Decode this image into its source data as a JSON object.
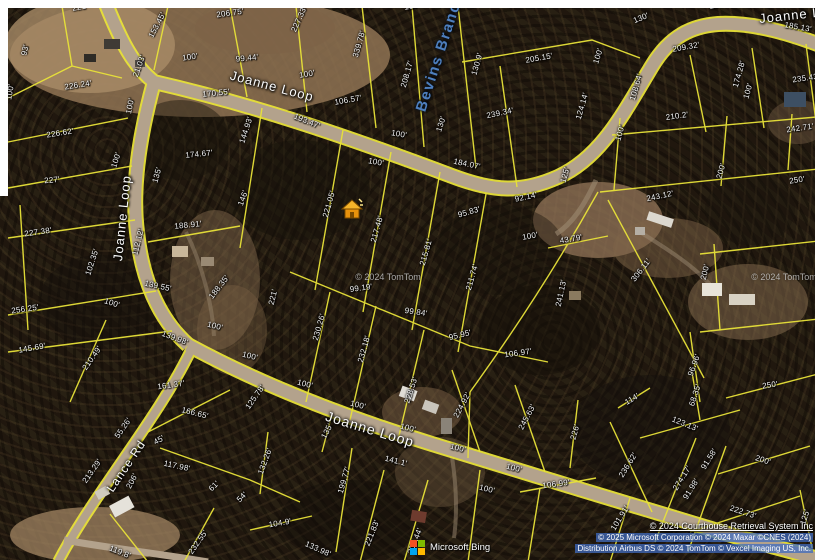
{
  "colors": {
    "parcel_line": "#e8e239",
    "road_fill": "#b3a28c",
    "water_label": "#4e7fbe",
    "marker_body": "#e8920c",
    "marker_roof": "#f5b32a"
  },
  "map": {
    "road_labels": [
      {
        "t": "Joanne Loop",
        "x": 272,
        "y": 86,
        "r": 15,
        "s": 13
      },
      {
        "t": "Joanne Loop",
        "x": 802,
        "y": 14,
        "r": -6,
        "s": 13
      },
      {
        "t": "Joanne Loop",
        "x": 122,
        "y": 218,
        "r": -84,
        "s": 13
      },
      {
        "t": "Joanne Loop",
        "x": 370,
        "y": 429,
        "r": 17,
        "s": 14
      },
      {
        "t": "Lance Rd",
        "x": 126,
        "y": 466,
        "r": -56,
        "s": 12
      }
    ],
    "water_labels": [
      {
        "t": "Bevins Branch",
        "x": 440,
        "y": 52,
        "r": -72,
        "s": 15
      }
    ],
    "dimension_labels": [
      {
        "t": "221'",
        "x": 80,
        "y": 7,
        "r": -10
      },
      {
        "t": "93'",
        "x": 25,
        "y": 50,
        "r": -78
      },
      {
        "t": "226.24'",
        "x": 78,
        "y": 85,
        "r": -9
      },
      {
        "t": "100'",
        "x": 10,
        "y": 92,
        "r": -80
      },
      {
        "t": "226.62'",
        "x": 60,
        "y": 133,
        "r": -9
      },
      {
        "t": "227'",
        "x": 52,
        "y": 180,
        "r": -6
      },
      {
        "t": "227.38'",
        "x": 38,
        "y": 232,
        "r": -8
      },
      {
        "t": "256.25'",
        "x": 25,
        "y": 309,
        "r": -8
      },
      {
        "t": "145.69'",
        "x": 32,
        "y": 348,
        "r": -10
      },
      {
        "t": "153.45'",
        "x": 157,
        "y": 25,
        "r": -62
      },
      {
        "t": "206.75'",
        "x": 230,
        "y": 13,
        "r": -8
      },
      {
        "t": "21.03'",
        "x": 139,
        "y": 66,
        "r": -70
      },
      {
        "t": "100'",
        "x": 130,
        "y": 106,
        "r": -78
      },
      {
        "t": "100'",
        "x": 116,
        "y": 160,
        "r": -72
      },
      {
        "t": "100'",
        "x": 190,
        "y": 57,
        "r": -8
      },
      {
        "t": "99.44'",
        "x": 247,
        "y": 58,
        "r": -6
      },
      {
        "t": "170.55'",
        "x": 216,
        "y": 93,
        "r": -6
      },
      {
        "t": "144.93'",
        "x": 246,
        "y": 130,
        "r": -72
      },
      {
        "t": "174.67'",
        "x": 199,
        "y": 154,
        "r": -6
      },
      {
        "t": "135'",
        "x": 157,
        "y": 175,
        "r": -74
      },
      {
        "t": "227.33'",
        "x": 299,
        "y": 19,
        "r": -66
      },
      {
        "t": "339.78'",
        "x": 359,
        "y": 44,
        "r": -74
      },
      {
        "t": "208.17'",
        "x": 407,
        "y": 74,
        "r": -74
      },
      {
        "t": "130.9'",
        "x": 477,
        "y": 64,
        "r": -74
      },
      {
        "t": "100'",
        "x": 307,
        "y": 74,
        "r": -10
      },
      {
        "t": "106.57'",
        "x": 348,
        "y": 100,
        "r": -10
      },
      {
        "t": "193.47'",
        "x": 307,
        "y": 121,
        "r": 22
      },
      {
        "t": "100'",
        "x": 399,
        "y": 134,
        "r": 10
      },
      {
        "t": "130'",
        "x": 441,
        "y": 124,
        "r": -72
      },
      {
        "t": "184.07'",
        "x": 467,
        "y": 164,
        "r": 12
      },
      {
        "t": "100'",
        "x": 376,
        "y": 162,
        "r": 10
      },
      {
        "t": "239.34'",
        "x": 500,
        "y": 113,
        "r": -12
      },
      {
        "t": "205.15'",
        "x": 539,
        "y": 58,
        "r": -10
      },
      {
        "t": "100'",
        "x": 412,
        "y": 6,
        "r": -10
      },
      {
        "t": "125'",
        "x": 717,
        "y": 5,
        "r": -10
      },
      {
        "t": "130'",
        "x": 641,
        "y": 18,
        "r": -22
      },
      {
        "t": "185.13'",
        "x": 798,
        "y": 27,
        "r": 10
      },
      {
        "t": "209.32'",
        "x": 686,
        "y": 47,
        "r": -10
      },
      {
        "t": "100'",
        "x": 598,
        "y": 56,
        "r": -72
      },
      {
        "t": "108.64'",
        "x": 636,
        "y": 87,
        "r": -74
      },
      {
        "t": "174.28'",
        "x": 739,
        "y": 74,
        "r": -74
      },
      {
        "t": "100'",
        "x": 748,
        "y": 91,
        "r": -74
      },
      {
        "t": "235.43'",
        "x": 806,
        "y": 78,
        "r": -8
      },
      {
        "t": "124.14'",
        "x": 582,
        "y": 106,
        "r": -74
      },
      {
        "t": "210.2'",
        "x": 677,
        "y": 116,
        "r": -8
      },
      {
        "t": "242.71'",
        "x": 800,
        "y": 128,
        "r": -8
      },
      {
        "t": "100'",
        "x": 620,
        "y": 133,
        "r": -74
      },
      {
        "t": "125'",
        "x": 565,
        "y": 175,
        "r": -74
      },
      {
        "t": "200'",
        "x": 721,
        "y": 171,
        "r": -74
      },
      {
        "t": "250'",
        "x": 797,
        "y": 180,
        "r": -8
      },
      {
        "t": "92.14'",
        "x": 526,
        "y": 197,
        "r": -12
      },
      {
        "t": "95.83'",
        "x": 469,
        "y": 212,
        "r": -16
      },
      {
        "t": "100'",
        "x": 530,
        "y": 236,
        "r": -10
      },
      {
        "t": "243.12'",
        "x": 660,
        "y": 196,
        "r": -12
      },
      {
        "t": "43.79'",
        "x": 571,
        "y": 239,
        "r": -10
      },
      {
        "t": "306.11'",
        "x": 641,
        "y": 270,
        "r": -52
      },
      {
        "t": "241.13'",
        "x": 561,
        "y": 293,
        "r": -78
      },
      {
        "t": "200'",
        "x": 705,
        "y": 272,
        "r": -76
      },
      {
        "t": "96.96'",
        "x": 694,
        "y": 365,
        "r": -70
      },
      {
        "t": "221.05'",
        "x": 329,
        "y": 204,
        "r": -74
      },
      {
        "t": "217.48'",
        "x": 377,
        "y": 229,
        "r": -74
      },
      {
        "t": "215.81'",
        "x": 426,
        "y": 252,
        "r": -74
      },
      {
        "t": "211.74'",
        "x": 472,
        "y": 277,
        "r": -74
      },
      {
        "t": "188.91'",
        "x": 188,
        "y": 225,
        "r": -6
      },
      {
        "t": "146'",
        "x": 243,
        "y": 198,
        "r": -70
      },
      {
        "t": "112.12'",
        "x": 138,
        "y": 242,
        "r": -76
      },
      {
        "t": "102.35'",
        "x": 92,
        "y": 262,
        "r": -72
      },
      {
        "t": "139.55'",
        "x": 158,
        "y": 286,
        "r": 12
      },
      {
        "t": "100'",
        "x": 112,
        "y": 303,
        "r": 18
      },
      {
        "t": "221'",
        "x": 273,
        "y": 297,
        "r": -76
      },
      {
        "t": "188.35'",
        "x": 219,
        "y": 287,
        "r": -52
      },
      {
        "t": "139.98'",
        "x": 175,
        "y": 338,
        "r": 20
      },
      {
        "t": "210.49'",
        "x": 92,
        "y": 358,
        "r": -55
      },
      {
        "t": "100'",
        "x": 215,
        "y": 326,
        "r": 14
      },
      {
        "t": "100'",
        "x": 250,
        "y": 356,
        "r": 14
      },
      {
        "t": "99.19'",
        "x": 361,
        "y": 288,
        "r": -8
      },
      {
        "t": "99.84'",
        "x": 416,
        "y": 312,
        "r": 8
      },
      {
        "t": "230.26'",
        "x": 319,
        "y": 327,
        "r": -74
      },
      {
        "t": "232.18'",
        "x": 364,
        "y": 349,
        "r": -74
      },
      {
        "t": "95.95'",
        "x": 460,
        "y": 335,
        "r": -14
      },
      {
        "t": "106.97'",
        "x": 518,
        "y": 353,
        "r": -8
      },
      {
        "t": "228.53'",
        "x": 411,
        "y": 390,
        "r": -72
      },
      {
        "t": "161.37'",
        "x": 171,
        "y": 385,
        "r": -8
      },
      {
        "t": "166.65'",
        "x": 195,
        "y": 413,
        "r": 14
      },
      {
        "t": "125.78'",
        "x": 255,
        "y": 397,
        "r": -55
      },
      {
        "t": "55.26'",
        "x": 123,
        "y": 428,
        "r": -55
      },
      {
        "t": "45'",
        "x": 159,
        "y": 440,
        "r": -30
      },
      {
        "t": "117.98'",
        "x": 177,
        "y": 466,
        "r": 12
      },
      {
        "t": "206'",
        "x": 132,
        "y": 481,
        "r": -62
      },
      {
        "t": "213.29'",
        "x": 92,
        "y": 471,
        "r": -55
      },
      {
        "t": "61'",
        "x": 214,
        "y": 486,
        "r": -45
      },
      {
        "t": "54'",
        "x": 242,
        "y": 497,
        "r": -45
      },
      {
        "t": "132.26'",
        "x": 265,
        "y": 461,
        "r": -70
      },
      {
        "t": "119.8'",
        "x": 120,
        "y": 552,
        "r": 22
      },
      {
        "t": "232.55'",
        "x": 198,
        "y": 542,
        "r": -55
      },
      {
        "t": "104.9'",
        "x": 280,
        "y": 523,
        "r": -10
      },
      {
        "t": "133.98'",
        "x": 318,
        "y": 549,
        "r": 24
      },
      {
        "t": "221.83'",
        "x": 372,
        "y": 533,
        "r": -68
      },
      {
        "t": "206.44'",
        "x": 415,
        "y": 541,
        "r": -68
      },
      {
        "t": "199.77'",
        "x": 344,
        "y": 480,
        "r": -74
      },
      {
        "t": "141.1'",
        "x": 396,
        "y": 461,
        "r": 14
      },
      {
        "t": "100'",
        "x": 305,
        "y": 384,
        "r": 14
      },
      {
        "t": "100'",
        "x": 358,
        "y": 405,
        "r": 14
      },
      {
        "t": "100'",
        "x": 408,
        "y": 428,
        "r": 14
      },
      {
        "t": "135'",
        "x": 327,
        "y": 431,
        "r": -62
      },
      {
        "t": "100'",
        "x": 458,
        "y": 448,
        "r": 14
      },
      {
        "t": "224.92'",
        "x": 462,
        "y": 405,
        "r": -62
      },
      {
        "t": "245.63'",
        "x": 527,
        "y": 417,
        "r": -62
      },
      {
        "t": "100'",
        "x": 514,
        "y": 468,
        "r": 14
      },
      {
        "t": "100'",
        "x": 487,
        "y": 489,
        "r": 14
      },
      {
        "t": "250'",
        "x": 770,
        "y": 385,
        "r": -8
      },
      {
        "t": "114'",
        "x": 632,
        "y": 399,
        "r": -30
      },
      {
        "t": "68.35'",
        "x": 695,
        "y": 395,
        "r": -72
      },
      {
        "t": "123.13'",
        "x": 685,
        "y": 424,
        "r": 22
      },
      {
        "t": "226'",
        "x": 575,
        "y": 432,
        "r": -74
      },
      {
        "t": "236.62'",
        "x": 628,
        "y": 465,
        "r": -58
      },
      {
        "t": "91.58'",
        "x": 709,
        "y": 459,
        "r": -58
      },
      {
        "t": "200'",
        "x": 763,
        "y": 460,
        "r": 18
      },
      {
        "t": "274.17'",
        "x": 682,
        "y": 478,
        "r": -58
      },
      {
        "t": "91.98'",
        "x": 691,
        "y": 489,
        "r": -58
      },
      {
        "t": "106.99'",
        "x": 556,
        "y": 484,
        "r": -8
      },
      {
        "t": "101.91'",
        "x": 620,
        "y": 518,
        "r": -58
      },
      {
        "t": "222.73'",
        "x": 743,
        "y": 512,
        "r": 18
      },
      {
        "t": "125'",
        "x": 805,
        "y": 517,
        "r": -72
      }
    ],
    "watermarks": [
      {
        "t": "© 2024 TomTom",
        "x": 388,
        "y": 277
      },
      {
        "t": "© 2024 TomTom",
        "x": 784,
        "y": 277
      }
    ],
    "attribution": {
      "line1": "© 2024 Courthouse Retrieval System Inc",
      "line2": "© 2025 Microsoft Corporation © 2024 Maxar ©CNES (2024)",
      "line3": "Distribution Airbus DS © 2024 TomTom © Vexcel Imaging US, Inc."
    },
    "logo_text": "Microsoft Bing",
    "marker_title": "subject-property"
  }
}
